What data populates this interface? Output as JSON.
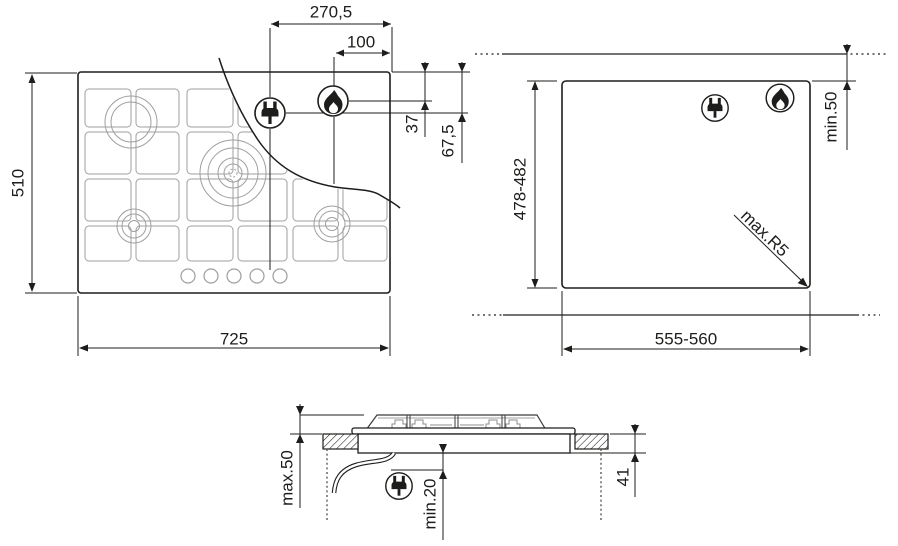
{
  "colors": {
    "line": "#1d1d1b",
    "grid": "#9f9f9f",
    "background": "#ffffff"
  },
  "top_view": {
    "dim_plug_to_right_edge": "270,5",
    "dim_flame_to_right_edge": "100",
    "dim_hob_depth": "510",
    "dim_hob_width": "725",
    "dim_flame_from_top": "37",
    "dim_plug_from_top": "67,5"
  },
  "cutout_view": {
    "dim_cutout_depth": "478-482",
    "dim_cutout_width": "555-560",
    "dim_wall_clearance": "min.50",
    "dim_corner_radius": "max.R5"
  },
  "side_view": {
    "dim_max_above_worktop": "max.50",
    "dim_min_clearance_below": "min.20",
    "dim_depth_below_worktop": "41"
  },
  "icons": {
    "plug": "power-plug-icon",
    "flame": "gas-flame-icon"
  }
}
